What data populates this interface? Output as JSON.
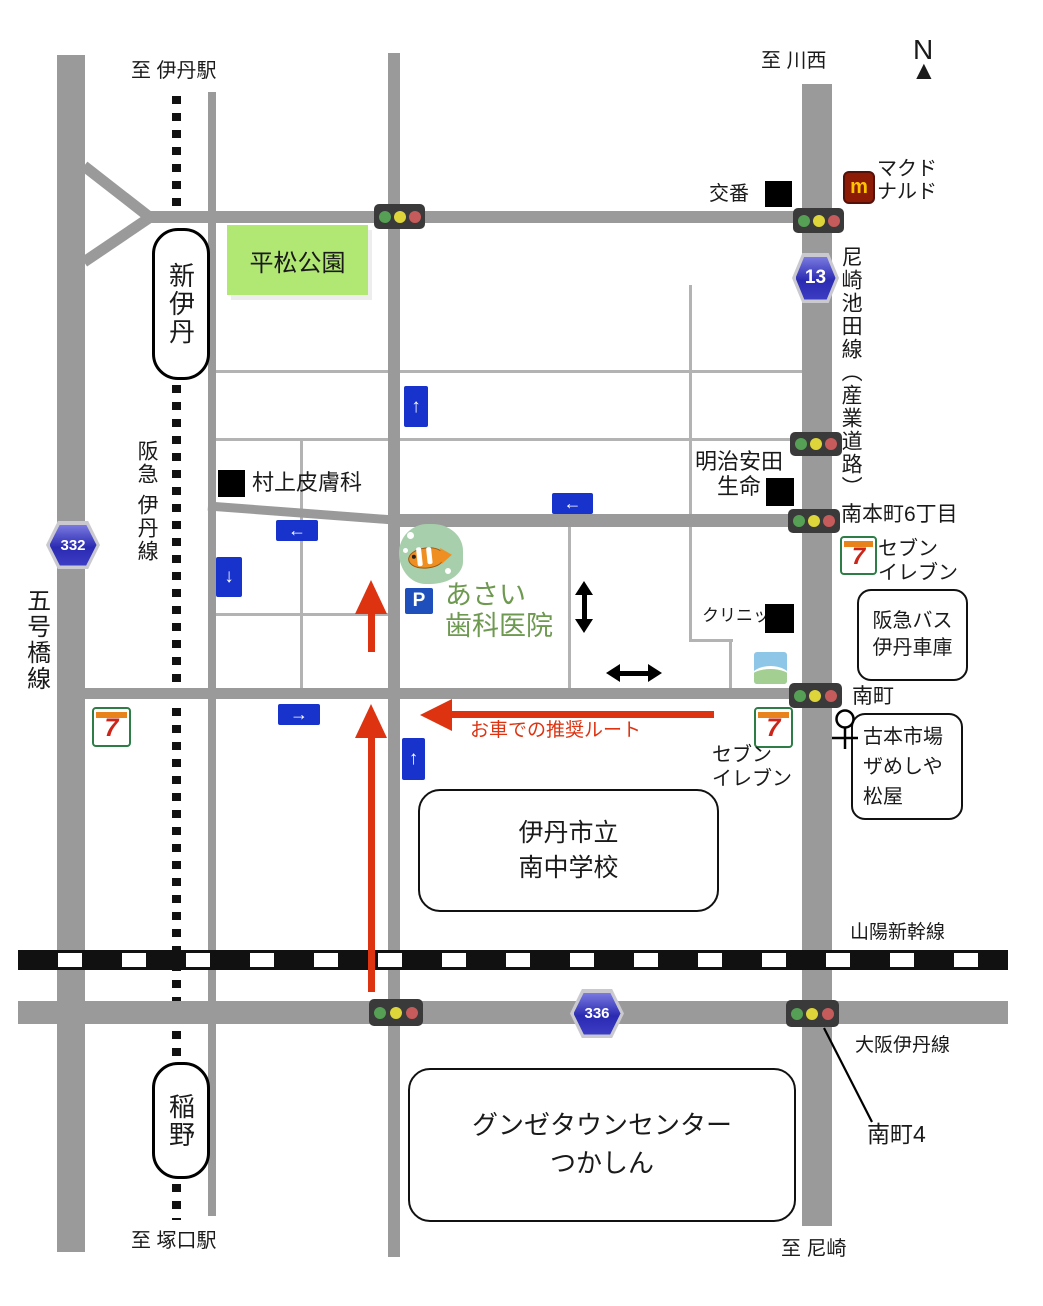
{
  "colors": {
    "road_gray": "#9a9a9a",
    "lane_gray": "#b3b3b3",
    "route_red": "#dd3311",
    "one_way_blue": "#1733cc",
    "route_badge_blue": "#2a2ab2",
    "park_green": "#b1e773",
    "clinic_text_green": "#6e9950"
  },
  "compass": {
    "n": "N"
  },
  "destinations": {
    "itami_station": "至 伊丹駅",
    "kawanishi": "至 川西",
    "tsukaguchi_station": "至 塚口駅",
    "amagasaki": "至 尼崎"
  },
  "stations": {
    "shin_itami": "新伊丹",
    "inano": "稲野"
  },
  "railways": {
    "hankyu_itami_line": "阪急 伊丹線",
    "sanyo_shinkansen": "山陽新幹線"
  },
  "roads": {
    "gogobashi_line": "五号橋線",
    "amagasaki_ikeda_line": "尼崎池田線（産業道路）",
    "osaka_itami_line": "大阪伊丹線",
    "minamihoncho6": "南本町6丁目",
    "minamicho": "南町",
    "minamicho4": "南町4",
    "route_332": "332",
    "route_13": "13",
    "route_336": "336"
  },
  "places": {
    "koban": "交番",
    "mcdonalds": [
      "マクド",
      "ナルド"
    ],
    "hiramatsu_park": "平松公園",
    "murakami_dermatology": "村上皮膚科",
    "meiji_yasuda": [
      "明治安田",
      "生命"
    ],
    "seven_eleven": [
      "セブン",
      "イレブン"
    ],
    "hankyu_bus_depot": [
      "阪急バス",
      "伊丹車庫"
    ],
    "clinic": "クリニック",
    "asai_dental": [
      "あさい",
      "歯科医院"
    ],
    "parking": "P",
    "furuhon": [
      "古本市場",
      "ザめしや",
      "松屋"
    ],
    "school": [
      "伊丹市立",
      "南中学校"
    ],
    "gunze": [
      "グンゼタウンセンター",
      "つかしん"
    ]
  },
  "route_note": "お車での推奨ルート",
  "icons": {
    "arrow_up": "↑",
    "arrow_down": "↓",
    "arrow_left": "←",
    "arrow_right": "→",
    "north_triangle": "▲",
    "mcdonalds_m": "m",
    "seven": "7"
  }
}
